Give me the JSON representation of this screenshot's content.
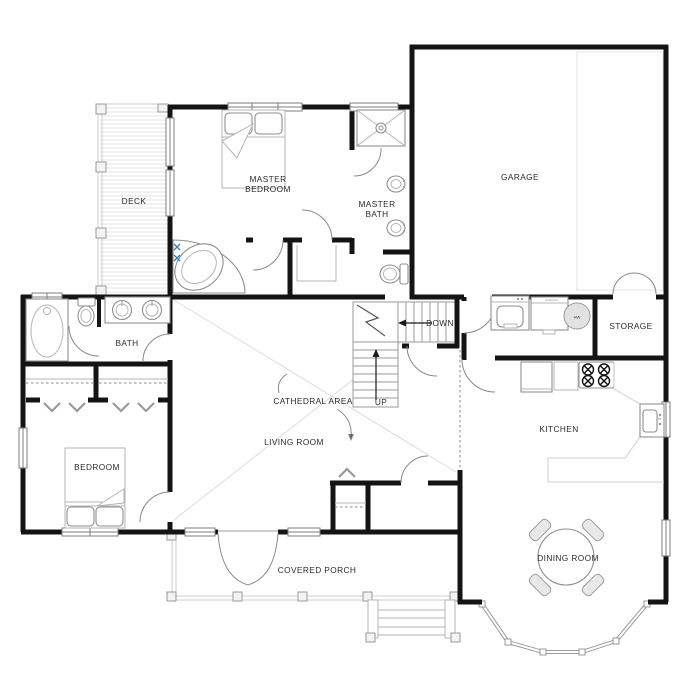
{
  "rooms": {
    "deck": "DECK",
    "master_bedroom_l1": "MASTER",
    "master_bedroom_l2": "BEDROOM",
    "master_bath_l1": "MASTER",
    "master_bath_l2": "BATH",
    "garage": "GARAGE",
    "bath": "BATH",
    "storage": "STORAGE",
    "cathedral_area": "CATHEDRAL AREA",
    "living_room": "LIVING ROOM",
    "kitchen": "KITCHEN",
    "bedroom": "BEDROOM",
    "covered_porch": "COVERED PORCH",
    "dining_room": "DINING ROOM"
  },
  "stairs": {
    "down": "DOWN",
    "up": "UP"
  },
  "equipment": {
    "water_heater": "HW"
  },
  "colors": {
    "wall": "#141414",
    "thin_line": "#999999",
    "light_line": "#dcdcdc",
    "label_text": "#2b2b2b",
    "accent_blue": "#3b7bbf"
  }
}
